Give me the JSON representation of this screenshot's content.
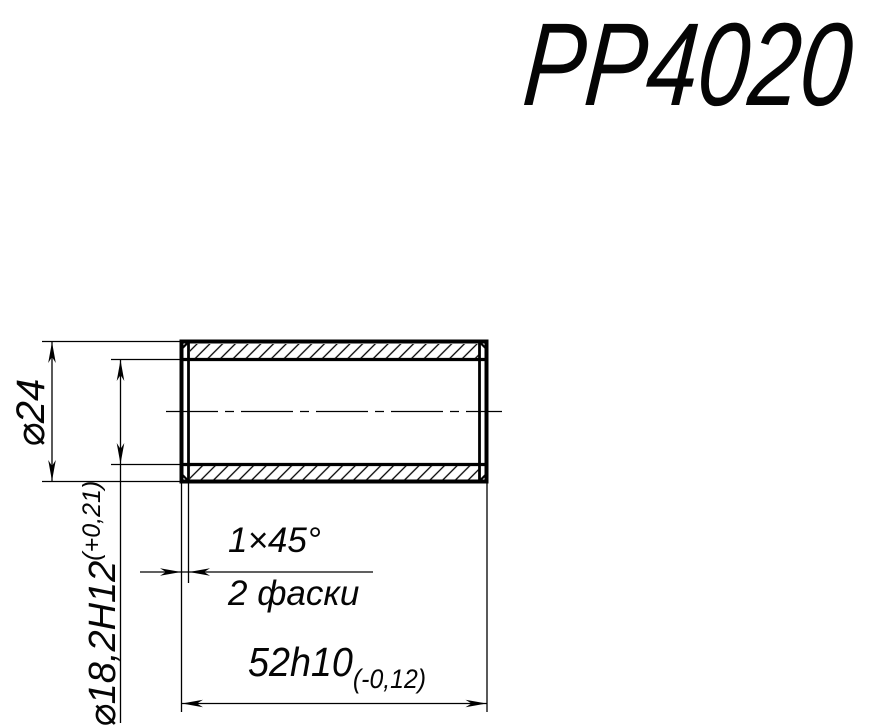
{
  "title": "PP4020",
  "drawing": {
    "type": "technical-section-view",
    "part": "cylindrical bushing (longitudinal section, hatched walls)",
    "labels": {
      "outer_diameter": "⌀24",
      "inner_diameter": "⌀18,2H12",
      "inner_diameter_tolerance": "(+0,21)",
      "chamfer": "1×45°",
      "chamfer_note": "2 фаски",
      "length": "52h10",
      "length_tolerance": "(-0,12)"
    },
    "colors": {
      "line": "#000000",
      "background": "#ffffff"
    }
  }
}
